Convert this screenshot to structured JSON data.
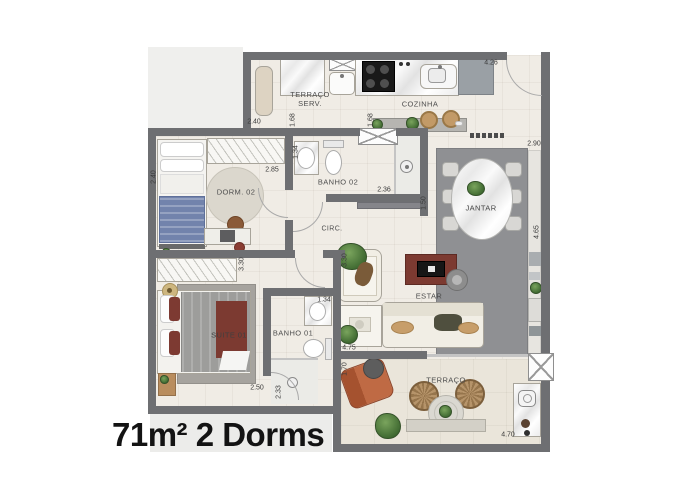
{
  "title": "71m² 2 Dorms",
  "rooms": {
    "terraco_serv_line1": "TERRAÇO",
    "terraco_serv_line2": "SERV.",
    "cozinha": "COZINHA",
    "dorm02": "DORM. 02",
    "banho02": "BANHO 02",
    "circ": "CIRC.",
    "jantar": "JANTAR",
    "suite01": "SUITE 01",
    "banho01": "BANHO 01",
    "estar": "ESTAR",
    "terraco": "TERRAÇO"
  },
  "dimensions": {
    "serv_width": "2.40",
    "serv_opening_left": "1.68",
    "serv_opening_right": "1.68",
    "cozinha_width": "4.26",
    "entry_wall": "2.90",
    "dorm02_wardrobe": "2.85",
    "banho02_left": "1.34",
    "banho02_width": "2.36",
    "jantar_left": "1.50",
    "jantar_height": "4.65",
    "dorm02_bed": "2.40",
    "suite_wardrobe": "3.30",
    "estar_left": "3.30",
    "banho01_top": "1.34",
    "estar_width": "4.75",
    "terraco_left": "1.70",
    "suite_width": "2.50",
    "banho01_left": "2.33",
    "terraco_width": "4.70"
  },
  "colors": {
    "wall": "#6e6f72",
    "floor": "#f0ece5",
    "terrace_floor": "#eae5da",
    "rug": "#8f9093",
    "accent_maroon": "#7c3a31",
    "terracotta": "#b4613f",
    "title_text": "#131313"
  }
}
